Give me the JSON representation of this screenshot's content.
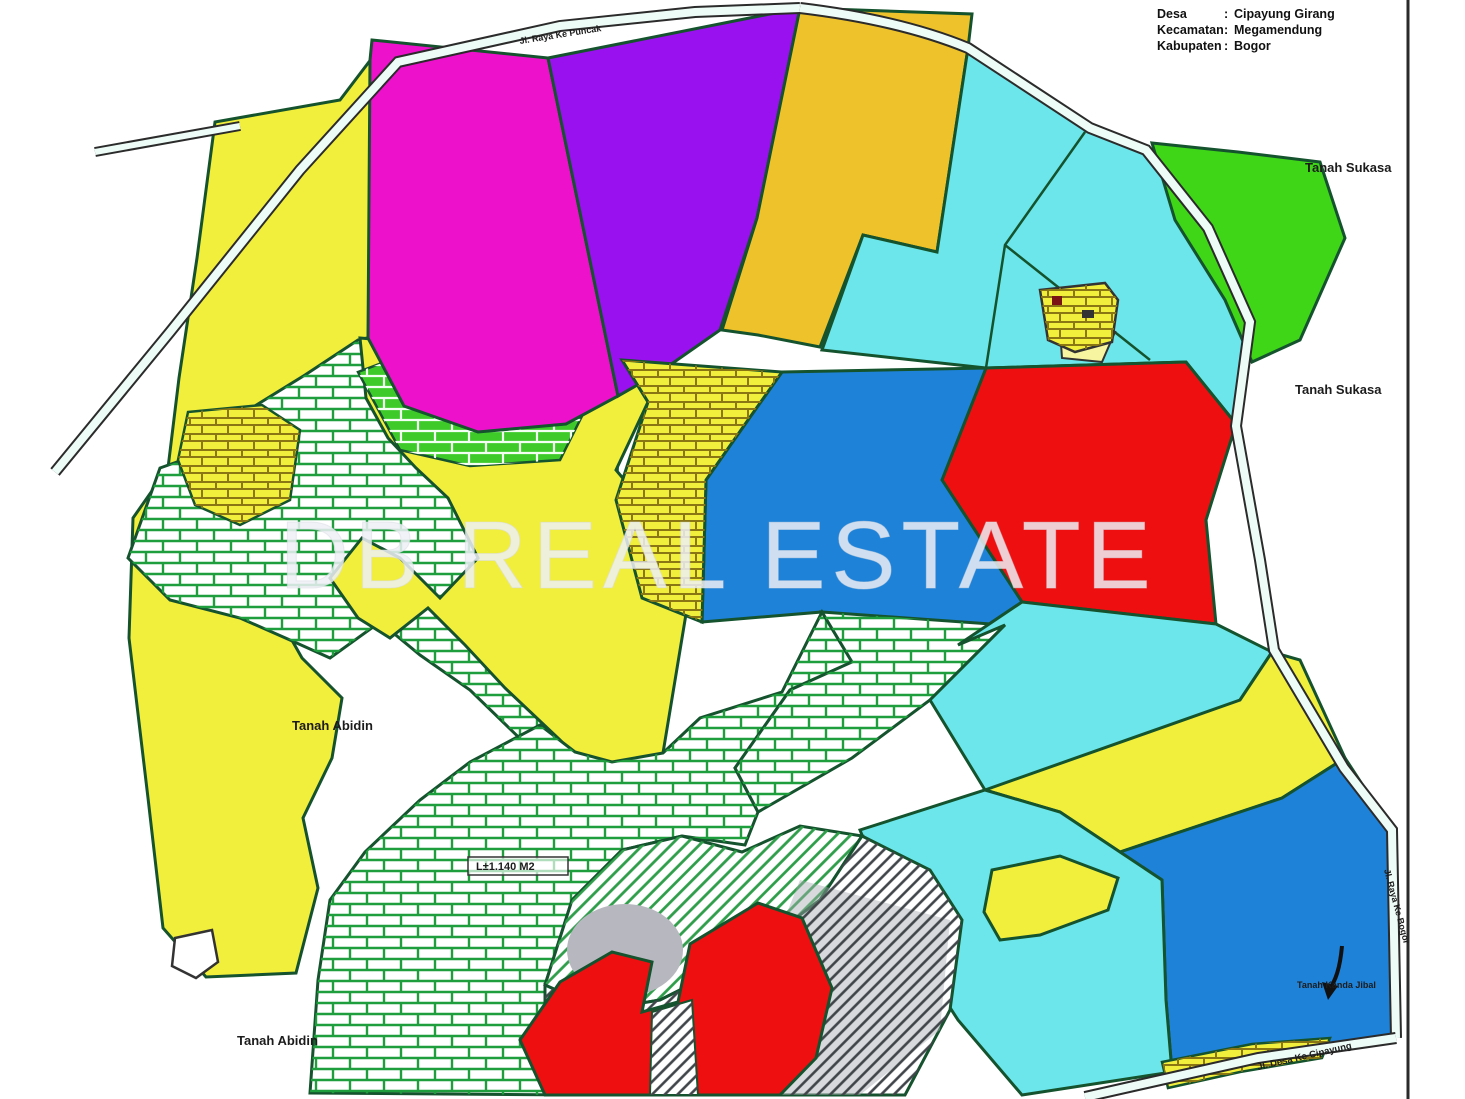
{
  "page": {
    "background": "#ffffff",
    "sheet_border_color": "#2a2a2a"
  },
  "legend": {
    "rows": [
      {
        "label": "Desa",
        "sep": ":",
        "value": "Cipayung Girang"
      },
      {
        "label": "Kecamatan",
        "sep": ":",
        "value": "Megamendung"
      },
      {
        "label": "Kabupaten",
        "sep": ":",
        "value": "Bogor"
      }
    ]
  },
  "watermark": {
    "text": "DB REAL ESTATE",
    "color": "#eef0f6"
  },
  "labels": {
    "tanah_sukasa_top": "Tanah Sukasa",
    "tanah_sukasa_mid": "Tanah Sukasa",
    "tanah_abidin_mid": "Tanah Abidin",
    "tanah_abidin_bottom": "Tanah Abidin",
    "tanah_kanda": "Tanah Kanda Jibal",
    "area_note": "L±1.140 M2",
    "road_top": "Jl. Raya Ke Puncak",
    "road_right": "Jl. Raya Ke Bogor",
    "road_bottom": "Jl. Desa Ke Cipayung"
  },
  "palette": {
    "yellow": "#f2ee3c",
    "magenta": "#ee11cc",
    "purple": "#9911ee",
    "gold": "#eec22a",
    "cyan": "#6ce6ea",
    "green_bright": "#3ed617",
    "red": "#ee1010",
    "blue": "#1e82d8",
    "brick_line_green": "#1f9e3e",
    "brick_fill_green": "#3ecb2a",
    "brick_line_olive": "#8a7714",
    "hatch_dark": "#40454a",
    "hatch_green": "#2f9e4a",
    "road_fill": "#eefcf8",
    "gray_patch": "#b7b7bf"
  }
}
